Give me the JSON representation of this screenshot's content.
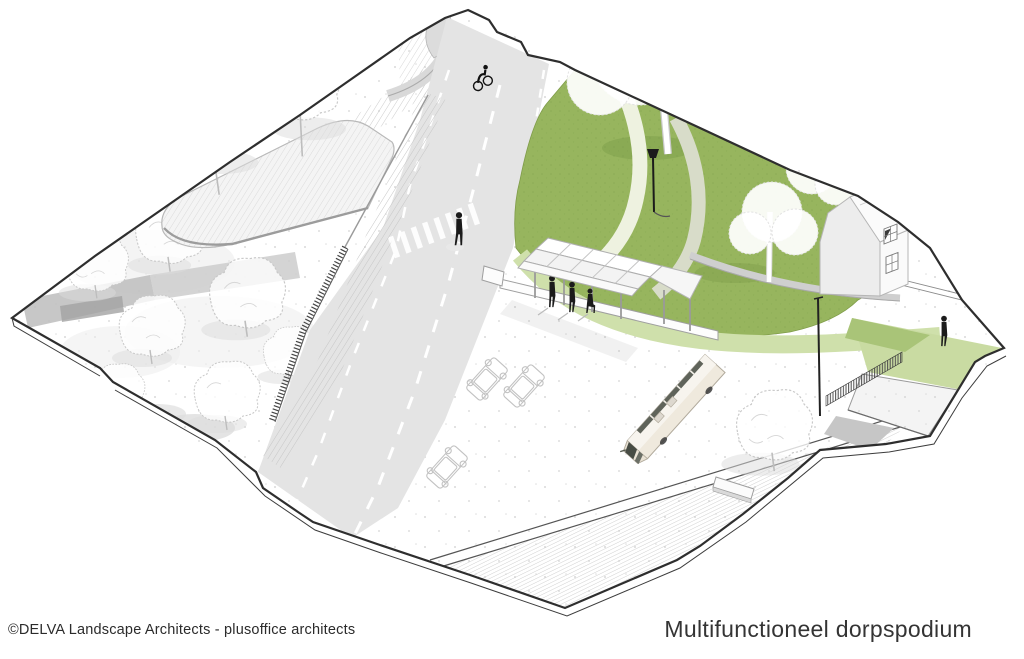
{
  "page": {
    "background": "#ffffff"
  },
  "footer": {
    "credit": "©DELVA Landscape Architects - plusoffice architects",
    "title": "Multifunctioneel dorpspodium"
  },
  "colors": {
    "park_green": "#97b55e",
    "park_green_texture": "#7da04a",
    "light_green_path": "#cfe0ab",
    "pale_green_slope": "#c9dba2",
    "road_gray": "#e4e4e4",
    "band_gray": "#bfbfbf",
    "outline": "#2e2e2e",
    "sketch_stroke": "#c9c9c9",
    "figure": "#1b1b1b",
    "bus_body": "#efe9dd",
    "bus_glass": "#474c44",
    "house_face": "#ededed",
    "house_white": "#fafafa"
  },
  "scene": {
    "elements": [
      "park lawn",
      "curved park paths",
      "bus shelter canopy",
      "platform",
      "village house",
      "bus",
      "parked cars",
      "zebra crossing",
      "cyclist",
      "pedestrians",
      "street lamp",
      "rail crossing",
      "underpass ramp",
      "sketched trees"
    ]
  }
}
